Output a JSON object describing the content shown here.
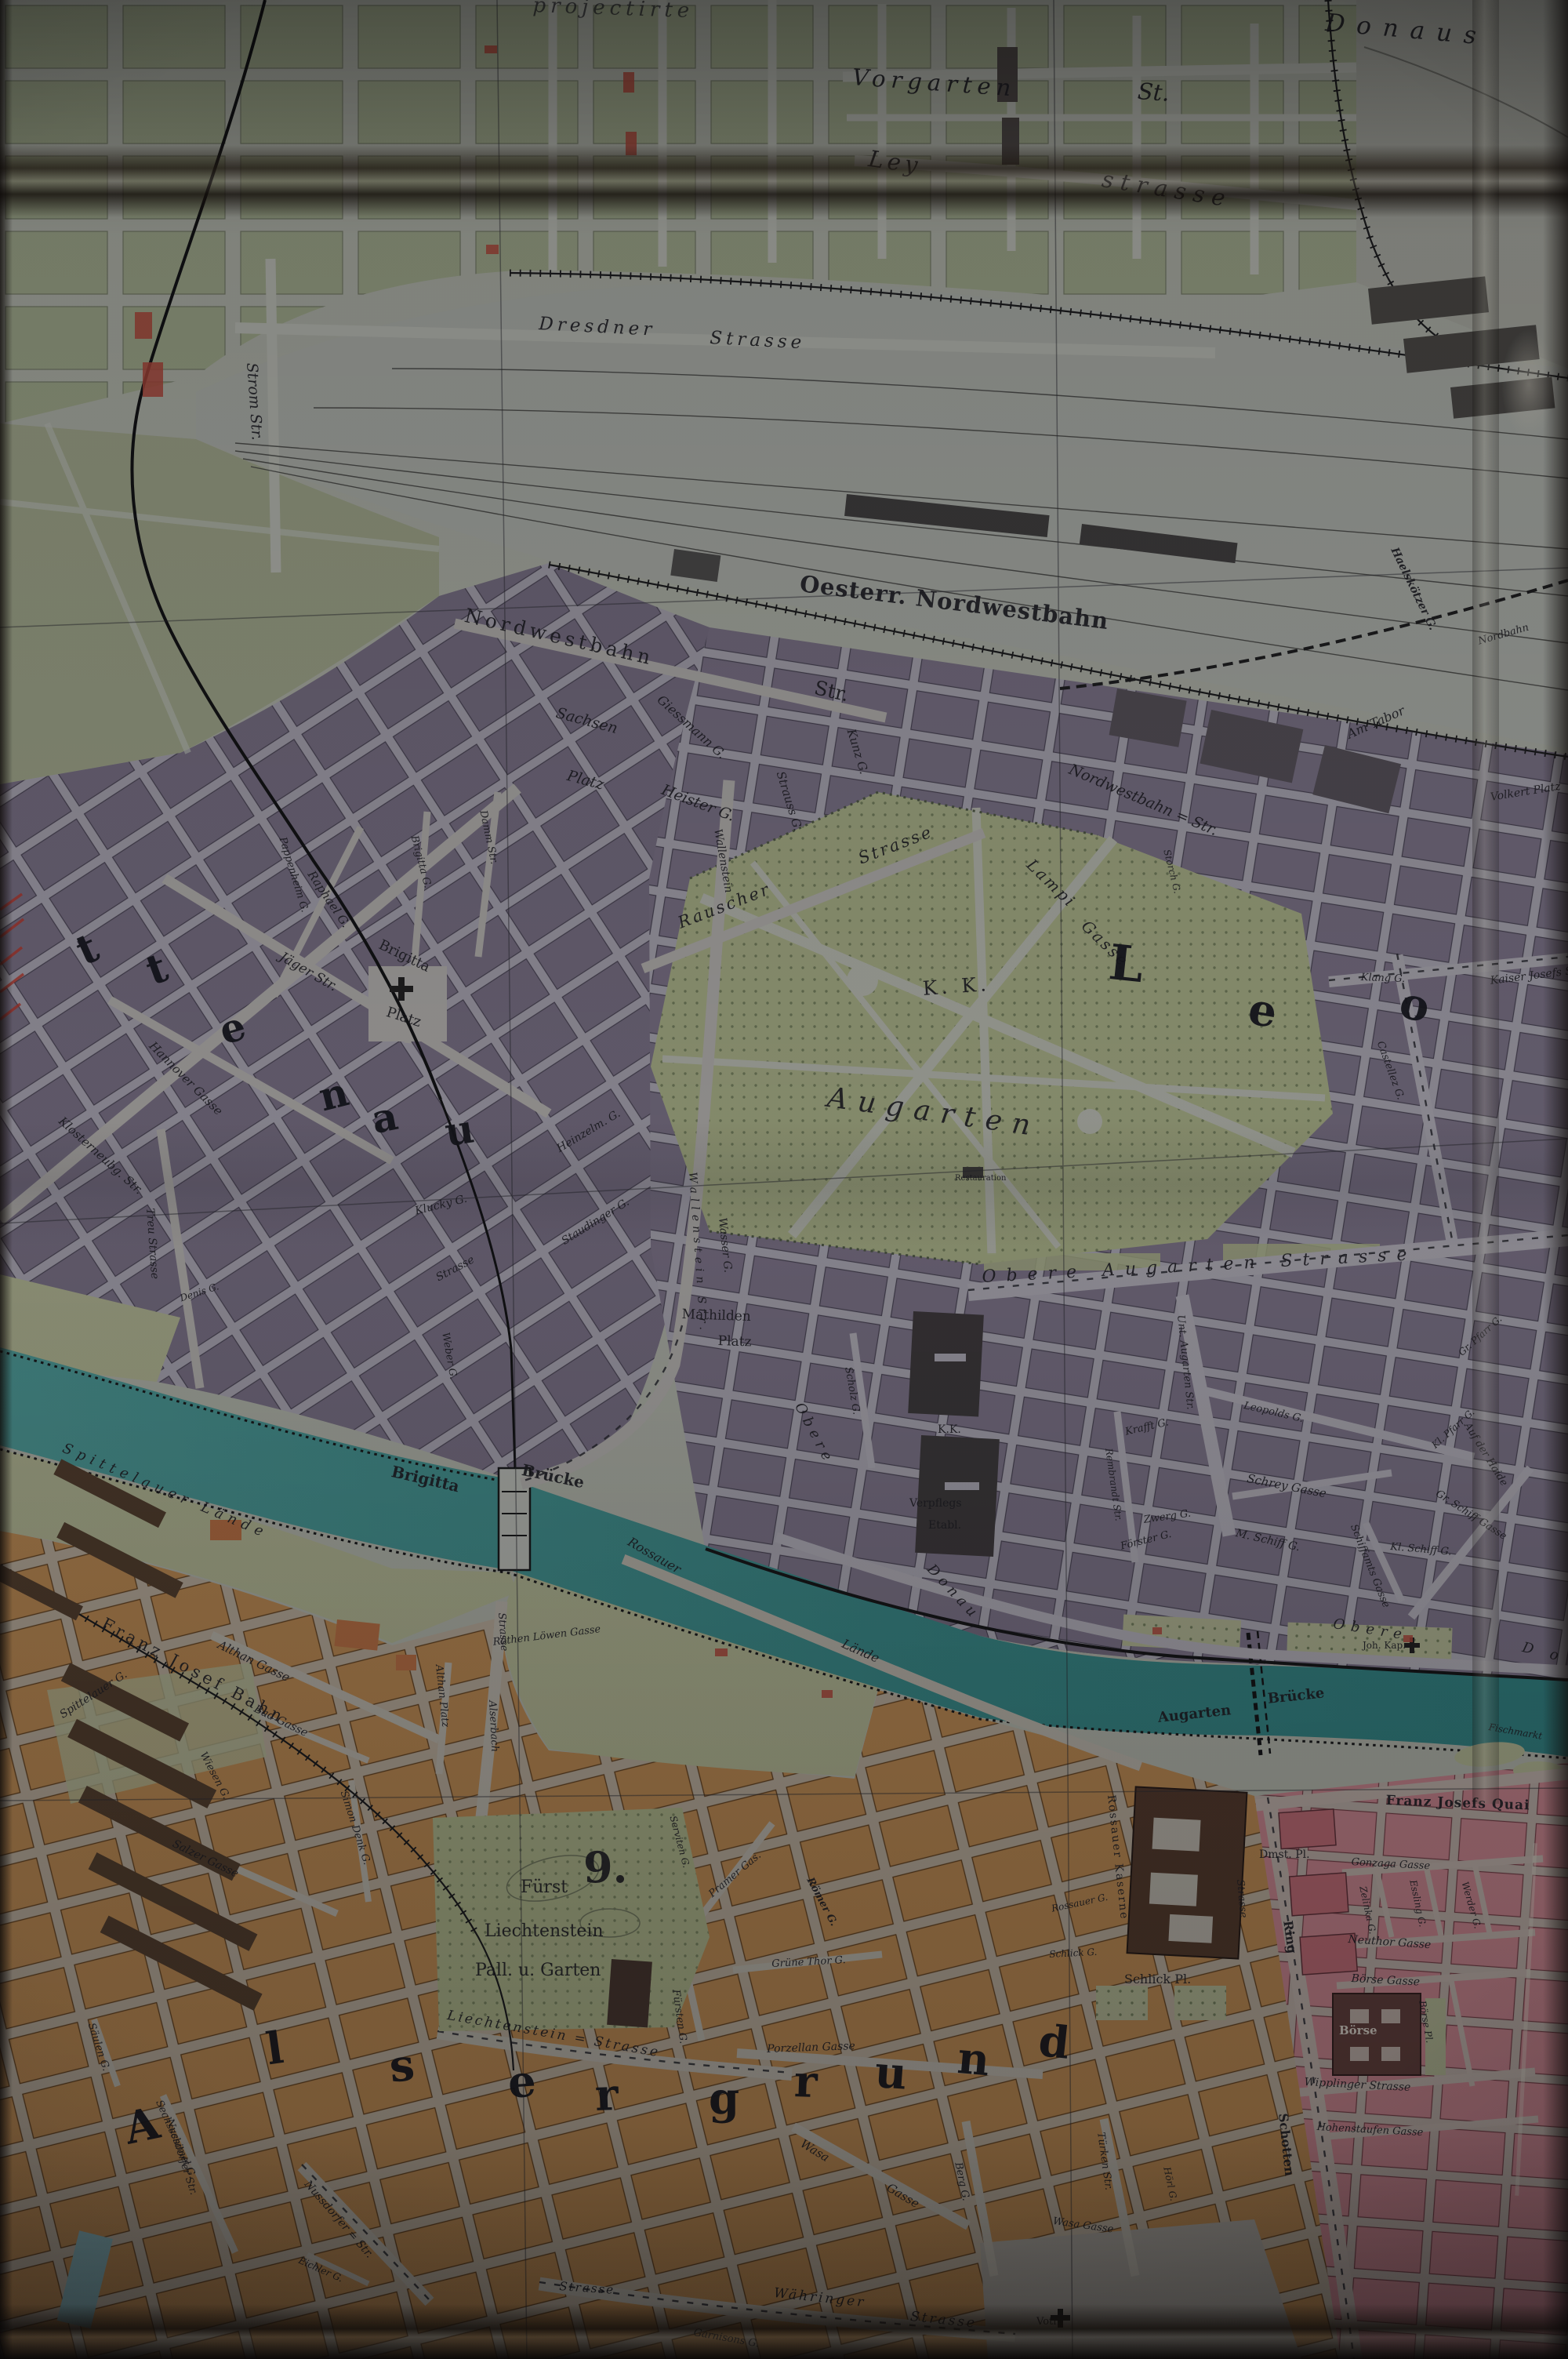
{
  "meta": {
    "title": "Photographed historic map sheet of Vienna (Donaukanal / Augarten area)"
  },
  "colors": {
    "paper_street": "#a9aca0",
    "blocks_green": "#99a283",
    "blocks_violet": "#746b7d",
    "blocks_orange": "#b3834c",
    "blocks_pink": "#bd7d84",
    "park_green": "#a3aa80",
    "water_teal": "#3a8783",
    "dark_building": "#4e3627",
    "rail_ink": "#191919",
    "label_ink": "#1d1c20",
    "red_accent": "#a84335"
  },
  "features": {
    "water": "Donau canal",
    "bridges": [
      "Brigitta Brücke",
      "Augarten Brücke"
    ],
    "railways": [
      "Oesterr. Nordwestbahn",
      "Franz Josef Bahn",
      "Nordbahn"
    ],
    "districts_visible": [
      "Brigittenau (…ttenau)",
      "Leopoldstadt (Leo…)",
      "Alsergrund"
    ],
    "district_number": "9."
  },
  "labels": [
    "projectirte",
    "Vorgarten",
    "St.",
    "Ley",
    "strasse",
    "Donaus",
    "Dresdner",
    "Strasse",
    "Strom Str.",
    "Oesterr. Nordwestbahn",
    "Nordwestbahn",
    "Str.",
    "Sachsen",
    "Platz",
    "Heister G.",
    "Giessmann G.",
    "Strauss G.",
    "Kunz G.",
    "Rauscher",
    "Strasse",
    "Nordwestbahn = Str.",
    "Lampi",
    "Gasse",
    "K. K.",
    "Augarten",
    "L",
    "e",
    "o",
    "t",
    "t",
    "e",
    "n",
    "a",
    "u",
    "Brigitta",
    "Platz",
    "Raphael G.",
    "Jäger Str.",
    "Hannover Gasse",
    "Klosterneubg. Str.",
    "Pappenheim G.",
    "Brigitta G.",
    "Damm Str.",
    "Wallenstein",
    "Wallenstein Str.",
    "Heinzelm. G.",
    "Staudinger G.",
    "Wasser G.",
    "Klucky G.",
    "Strasse",
    "Weber G.",
    "Treu Strasse",
    "Denis G.",
    "Mathilden",
    "Platz",
    "Obere Augarten Strasse",
    "Unt. Augarten Str.",
    "Scholz G.",
    "K.K.",
    "Verpflegs",
    "Etabl.",
    "Obere",
    "Donau",
    "Obere",
    "D o",
    "Krafft G.",
    "Rembrandt Str.",
    "Zwerg G.",
    "Förster G.",
    "Leopolds G.",
    "Schrey Gasse",
    "M. Schiff G.",
    "Kl. Schiff G.",
    "Schiffamts Gasse",
    "Gr. Schiff Gasse",
    "Auf der Haide",
    "Kl. Pfarr G.",
    "Gr. Pfarr G.",
    "Klang G.",
    "Kaiser Josefs Str.",
    "Castellez G.",
    "Storch G.",
    "Haelskötzer G.",
    "Am Tabor",
    "Volkert Platz",
    "Nordbahn",
    "Spittelauer Lände",
    "Brigitta",
    "Brücke",
    "Augarten",
    "Brücke",
    "Rossauer",
    "Lände",
    "Franz Josef Bahn",
    "Röthen Löwen Gasse",
    "Strasse",
    "Alserbach",
    "Althan Platz",
    "Spittelauer G.",
    "Althan Gasse",
    "Bad Gasse",
    "Wiesen G.",
    "Salzer Gasse",
    "Simon Denk G.",
    "9.",
    "Fürst",
    "Liechtenstein",
    "Pall. u. Garten",
    "Liechtenstein = Strasse",
    "Fürsten G.",
    "Serviten G.",
    "Pramer Gas.",
    "Römer G.",
    "Grüne Thor G.",
    "Porzellan Gasse",
    "A",
    "l",
    "s",
    "e",
    "r",
    "g",
    "r",
    "u",
    "n",
    "d",
    "Säulen G.",
    "Sechsschimel G.",
    "Nussdorfer = Str.",
    "Eichler G.",
    "Währinger",
    "Strasse",
    "Strasse",
    "Wasa",
    "Gasse",
    "Berg G.",
    "Türken Str.",
    "Wasa Gasse",
    "Hörl G.",
    "Garnisons G.",
    "Votiv",
    "Nussdorfer Str.",
    "Rossauer Kaserne",
    "Schlick Pl.",
    "Schlick G.",
    "Rossauer G.",
    "Dmst. Pl.",
    "Ring",
    "Schotten",
    "Strasse",
    "Franz Josefs Quai",
    "Fischmarkt",
    "Joh. Kap.",
    "Gonzaga Gasse",
    "Zelinka G.",
    "Essling G.",
    "Werder G.",
    "Neuthor Gasse",
    "Börse Gasse",
    "Börse",
    "Börse Pl.",
    "Wipplinger Strasse",
    "Hohenstaufen Gasse",
    "Restauration"
  ]
}
